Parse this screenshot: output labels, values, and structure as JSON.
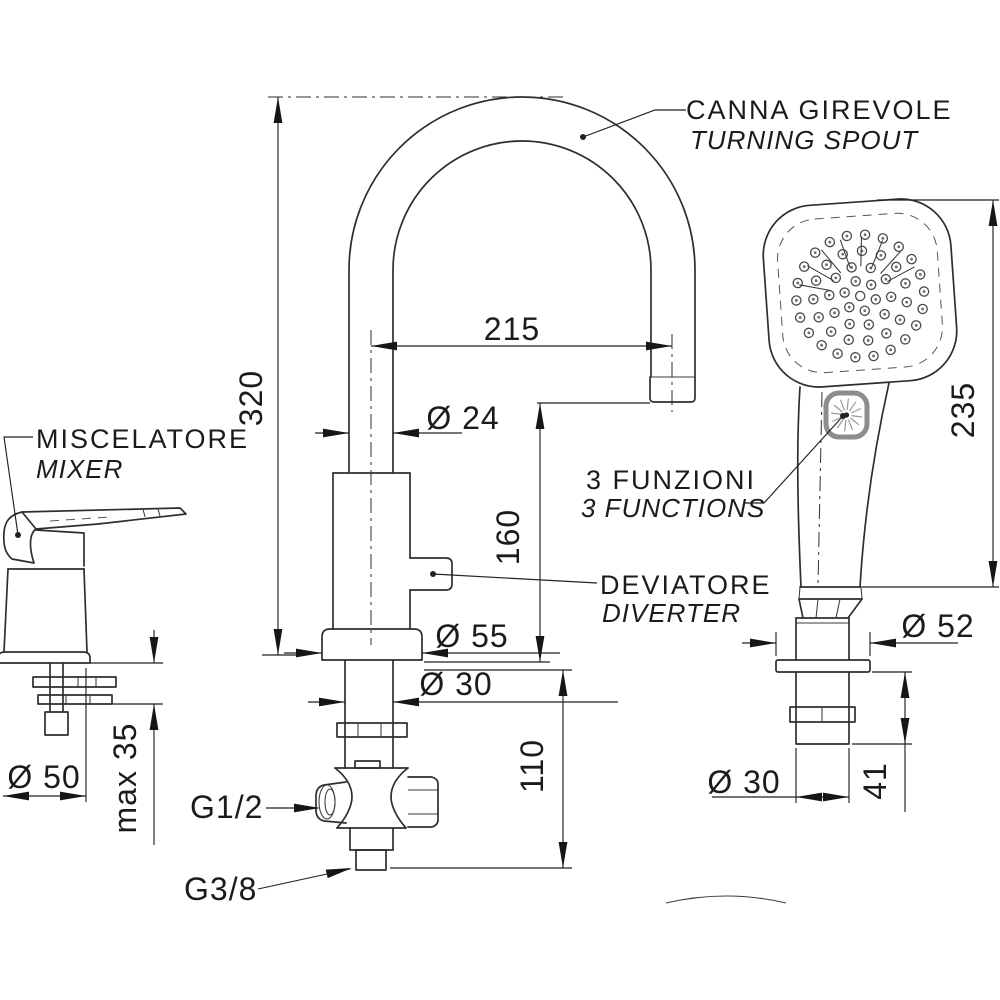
{
  "labels": {
    "spout_it": "CANNA  GIREVOLE",
    "spout_en": "TURNING SPOUT",
    "mixer_it": "MISCELATORE",
    "mixer_en": "MIXER",
    "functions_it": "3 FUNZIONI",
    "functions_en": "3 FUNCTIONS",
    "diverter_it": "DEVIATORE",
    "diverter_en": "DIVERTER"
  },
  "dimensions": {
    "spout_height": "320",
    "spout_reach": "215",
    "spout_tube_diameter": "Ø 24",
    "outlet_height": "160",
    "base_flange_diameter": "Ø 55",
    "shank_diameter": "Ø 30",
    "under_deck_depth": "110",
    "mixer_base_diameter": "Ø 50",
    "max_deck_thickness": "max 35",
    "inlet_thread": "G1/2",
    "outlet_thread": "G3/8",
    "handshower_length": "235",
    "holder_flange_diameter": "Ø 52",
    "holder_shank_diameter": "Ø 30",
    "holder_under_deck": "41"
  },
  "ink_color": "#2e2e2e",
  "button_ring_color": "#8d8d8d"
}
